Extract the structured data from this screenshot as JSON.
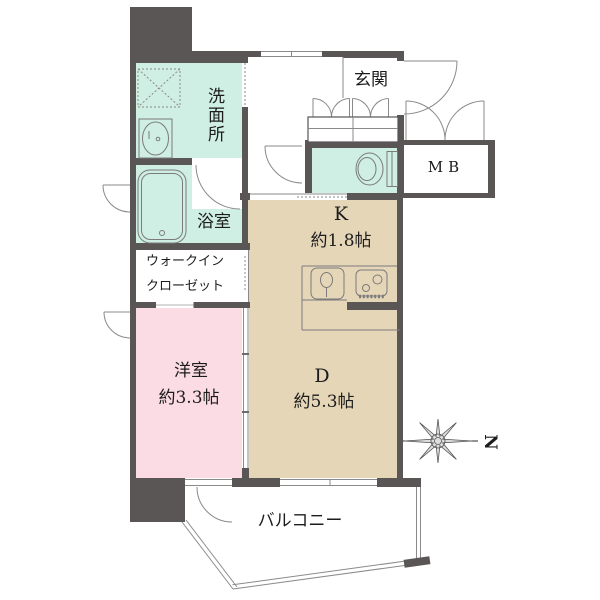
{
  "plan": {
    "rooms": {
      "washroom_label": "洗面所",
      "bathroom_label": "浴室",
      "wic_line1": "ウォークイン",
      "wic_line2": "クローゼット",
      "entrance_label": "玄関",
      "meter_box_label": "MB",
      "kitchen_label": "K",
      "kitchen_size": "約1.8帖",
      "dining_label": "D",
      "dining_size": "約5.3帖",
      "western_room_label": "洋室",
      "western_room_size": "約3.3帖",
      "balcony_label": "バルコニー"
    },
    "compass": {
      "north_label": "N"
    },
    "colors": {
      "wall": "#5a5656",
      "wet_area_fill": "#cfeee4",
      "kitchen_dining_fill": "#e6d6b8",
      "bedroom_fill": "#fbdce4",
      "background": "#ffffff"
    }
  }
}
